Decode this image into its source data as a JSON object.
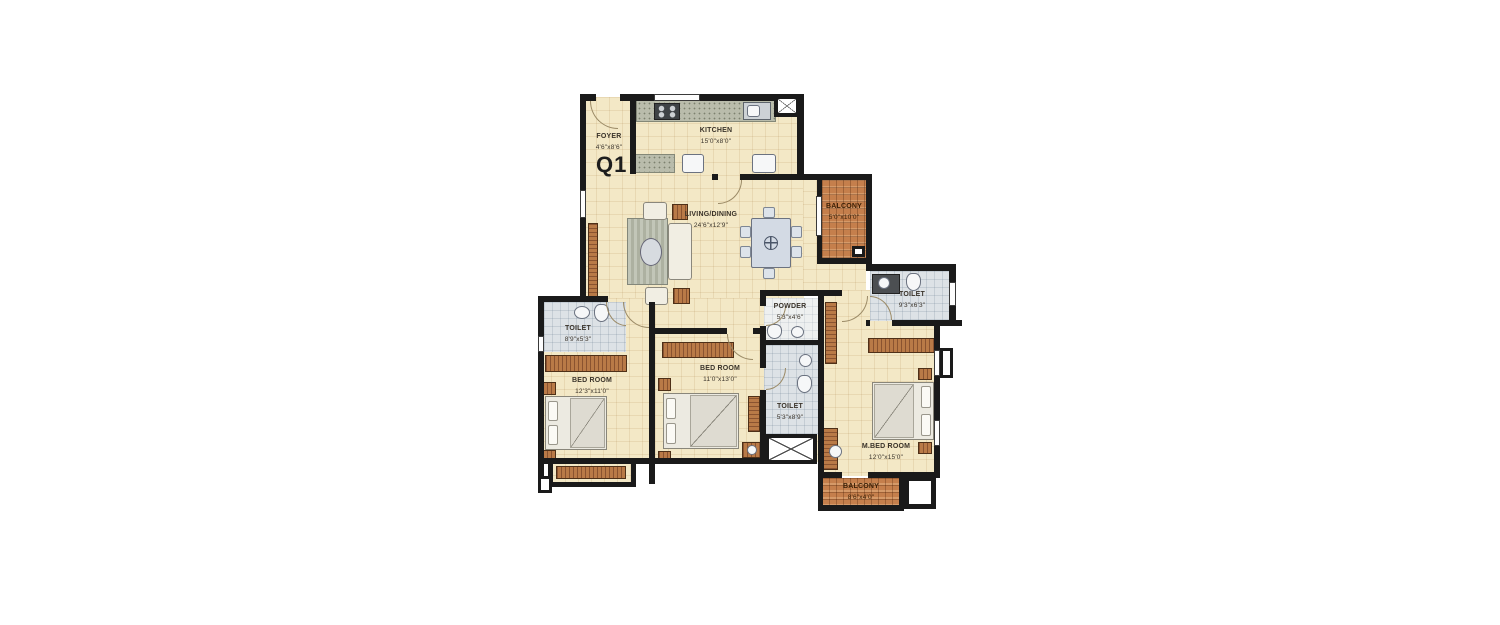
{
  "unit_label": "Q1",
  "rooms": [
    {
      "id": "foyer",
      "name": "FOYER",
      "dims": "4'6\"x8'6\""
    },
    {
      "id": "kitchen",
      "name": "KITCHEN",
      "dims": "15'0\"x8'0\""
    },
    {
      "id": "living_dining",
      "name": "LIVING/DINING",
      "dims": "24'6\"x12'9\""
    },
    {
      "id": "balcony_top",
      "name": "BALCONY",
      "dims": "5'0\"x10'0\""
    },
    {
      "id": "toilet_right",
      "name": "TOILET",
      "dims": "9'3\"x6'3\""
    },
    {
      "id": "powder",
      "name": "POWDER",
      "dims": "5'3\"x4'6\""
    },
    {
      "id": "toilet_left",
      "name": "TOILET",
      "dims": "8'9\"x5'3\""
    },
    {
      "id": "bedroom_left",
      "name": "BED ROOM",
      "dims": "12'3\"x11'0\""
    },
    {
      "id": "bedroom_middle",
      "name": "BED ROOM",
      "dims": "11'0\"x13'0\""
    },
    {
      "id": "toilet_middle",
      "name": "TOILET",
      "dims": "5'3\"x8'9\""
    },
    {
      "id": "master_bedroom",
      "name": "M.BED ROOM",
      "dims": "12'0\"x15'0\""
    },
    {
      "id": "balcony_bottom",
      "name": "BALCONY",
      "dims": "8'6\"x4'0\""
    }
  ],
  "colors": {
    "wall": "#1a1a1a",
    "floor": "#f3e8c6",
    "tile_balcony": "#c57f4c",
    "toilet_floor": "#dde2e6",
    "counter": "#b9bcab",
    "label_text": "#3a332a",
    "background": "#ffffff"
  }
}
